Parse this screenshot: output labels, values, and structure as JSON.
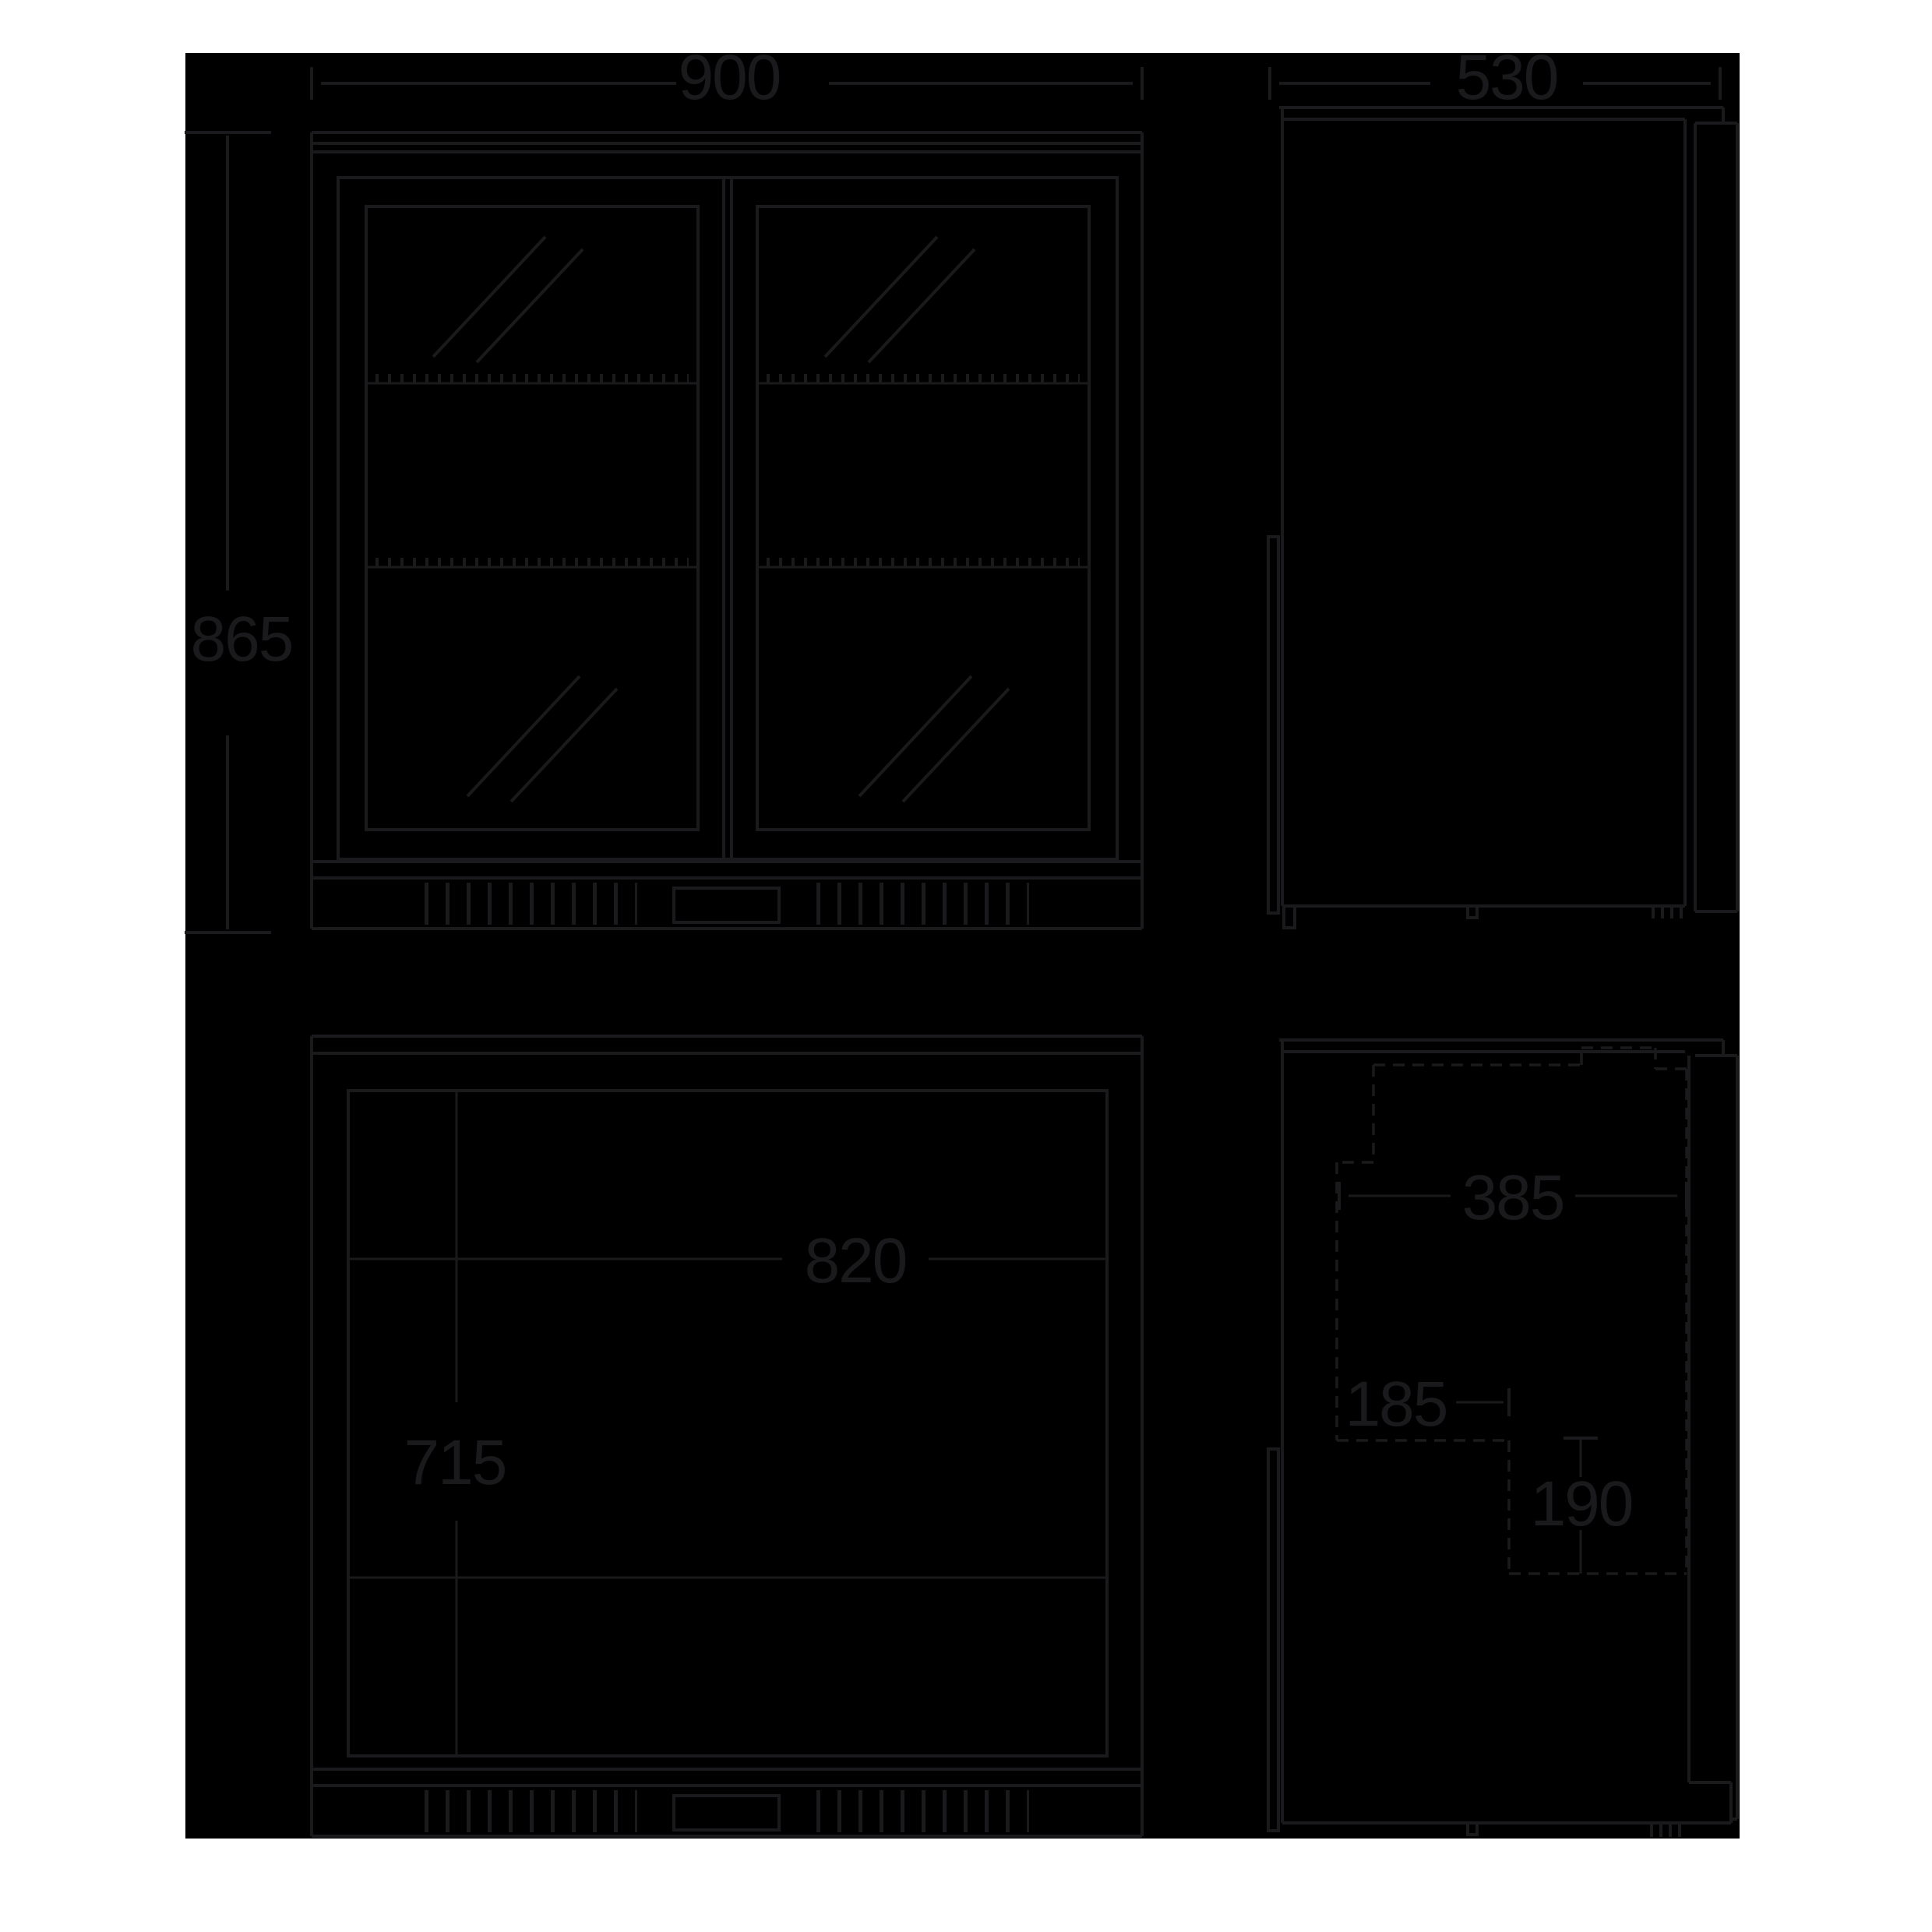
{
  "drawing": {
    "type": "product-dimension-diagram",
    "subject": "double-door back-bar fridge",
    "colors": {
      "page_background": "#ffffff",
      "canvas_background": "#000000",
      "line": "#1a1a1c"
    },
    "views": {
      "front": {
        "width_label": "900",
        "height_label": "865"
      },
      "side": {
        "depth_label": "530"
      },
      "front_internal": {
        "interior_width_label": "820",
        "interior_height_label": "715"
      },
      "side_internal": {
        "interior_depth_label": "385",
        "recess_depth_label": "185",
        "recess_height_label": "190"
      }
    }
  }
}
